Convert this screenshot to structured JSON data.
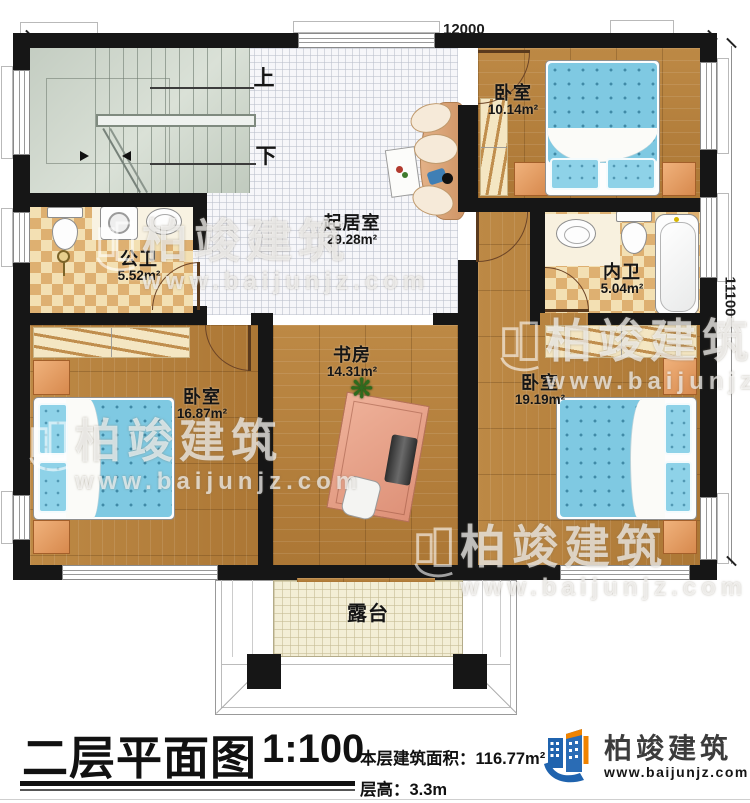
{
  "watermark": {
    "brand": "柏竣建筑",
    "url": "www.baijunjz.com"
  },
  "dimensions": {
    "top": "12000",
    "right": "11100"
  },
  "stairs": {
    "up_label": "上",
    "down_label": "下"
  },
  "rooms": {
    "bedroom_top": {
      "name": "卧室",
      "area": "10.14m²"
    },
    "living": {
      "name": "起居室",
      "area": "29.28m²"
    },
    "public_bath": {
      "name": "公卫",
      "area": "5.52m²"
    },
    "inner_bath": {
      "name": "内卫",
      "area": "5.04m²"
    },
    "bedroom_left": {
      "name": "卧室",
      "area": "16.87m²"
    },
    "study": {
      "name": "书房",
      "area": "14.31m²"
    },
    "bedroom_right": {
      "name": "卧室",
      "area": "19.19m²"
    },
    "terrace": {
      "name": "露台"
    }
  },
  "titleblock": {
    "title": "二层平面图",
    "scale": "1:100",
    "area_label": "本层建筑面积：",
    "area_value": "116.77m²",
    "floor_height_label": "层高：",
    "floor_height_value": "3.3m"
  },
  "logo": {
    "brand": "柏竣建筑",
    "url": "www.baijunjz.com"
  },
  "colors": {
    "wall": "#161616",
    "wood": "#b5813f",
    "bed_blue": "#7fc9e2",
    "brand_blue": "#1f63ae",
    "brand_orange": "#f08300"
  }
}
